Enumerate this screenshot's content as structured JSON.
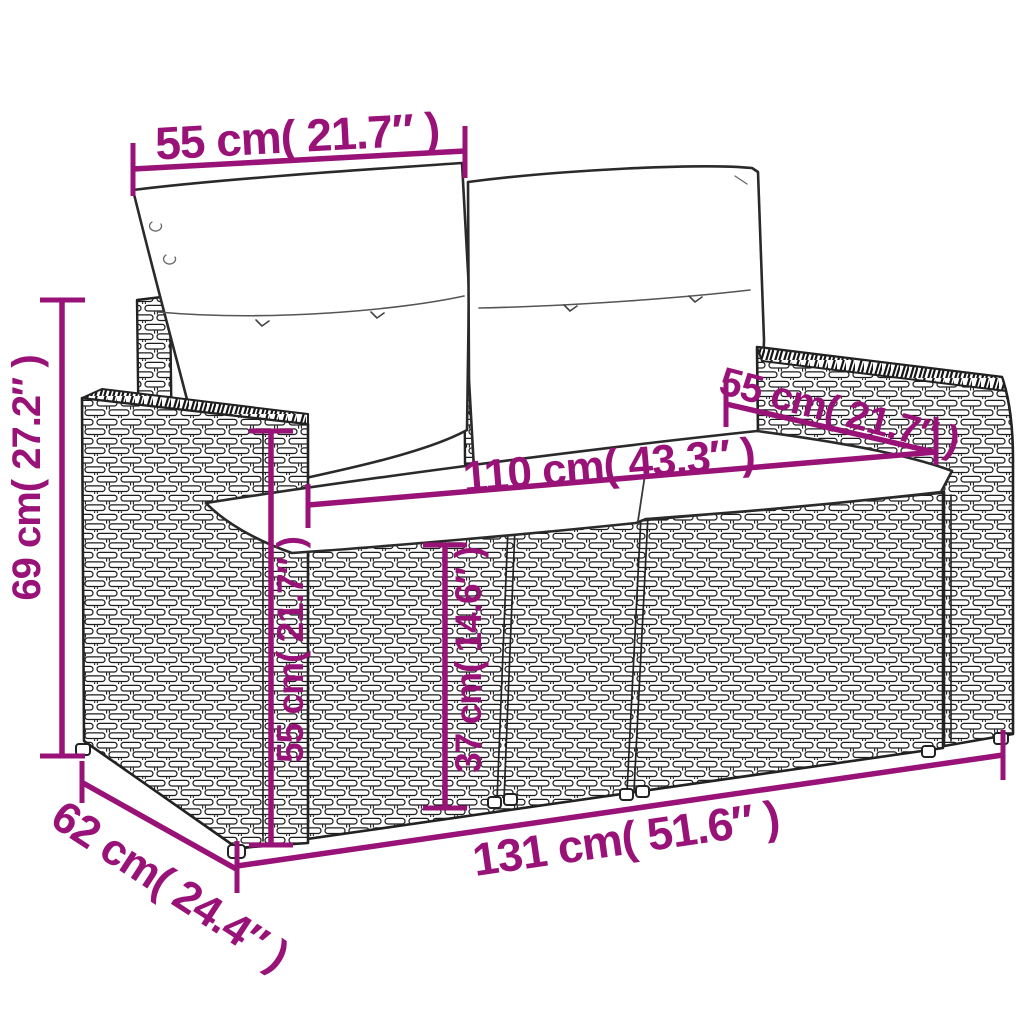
{
  "figure": {
    "type": "product-dimension-diagram",
    "subject": "rattan garden loveseat with back and seat cushions",
    "accent_color": "#991277",
    "line_color": "#222222",
    "background": "#ffffff"
  },
  "dims": [
    {
      "name": "backrest-cushion-width",
      "label": "55 cm( 21.7″ )"
    },
    {
      "name": "overall-height",
      "label": "69 cm( 27.2″ )"
    },
    {
      "name": "seat-width",
      "label": "110 cm( 43.3″ )"
    },
    {
      "name": "seat-depth",
      "label": "55 cm( 21.7″ )"
    },
    {
      "name": "armrest-height",
      "label": "55 cm( 21.7″ )"
    },
    {
      "name": "seat-height",
      "label": "37 cm( 14.6″ )"
    },
    {
      "name": "overall-width",
      "label": "131 cm( 51.6″ )"
    },
    {
      "name": "overall-depth",
      "label": "62 cm( 24.4″ )"
    }
  ]
}
